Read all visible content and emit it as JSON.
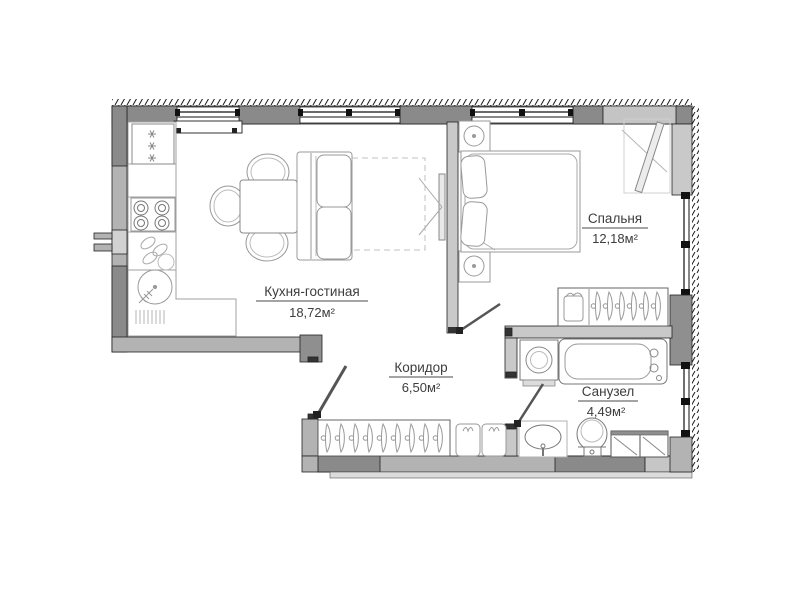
{
  "plan": {
    "rooms": [
      {
        "id": "kitchen-living",
        "name": "Кухня-гостиная",
        "area": "18,72м²"
      },
      {
        "id": "bedroom",
        "name": "Спальня",
        "area": "12,18м²"
      },
      {
        "id": "corridor",
        "name": "Коридор",
        "area": "6,50м²"
      },
      {
        "id": "bathroom",
        "name": "Санузел",
        "area": "4,49м²"
      }
    ],
    "colors": {
      "background": "#ffffff",
      "wall_dark": "#8a8a8a",
      "wall_mid": "#b3b3b3",
      "wall_light": "#cfcfcf",
      "outline": "#222222",
      "furniture_stroke": "#999999",
      "label_text": "#3d3d3d"
    },
    "icons": {
      "fridge-icon": "three snowflake asterisks",
      "stove-icon": "four burner circles",
      "kitchen-sink-icon": "dish arcs",
      "radiator-icon": "vertical hatch lines",
      "hanger-icon": "hook circle + crescent blade",
      "tv-icon": "thin panel with bracket lines",
      "washing-machine-icon": "square with drum circle",
      "bathtub-icon": "double rounded rectangle",
      "toilet-icon": "oval bowl with tank",
      "sink-icon": "oval basin with tap"
    }
  }
}
